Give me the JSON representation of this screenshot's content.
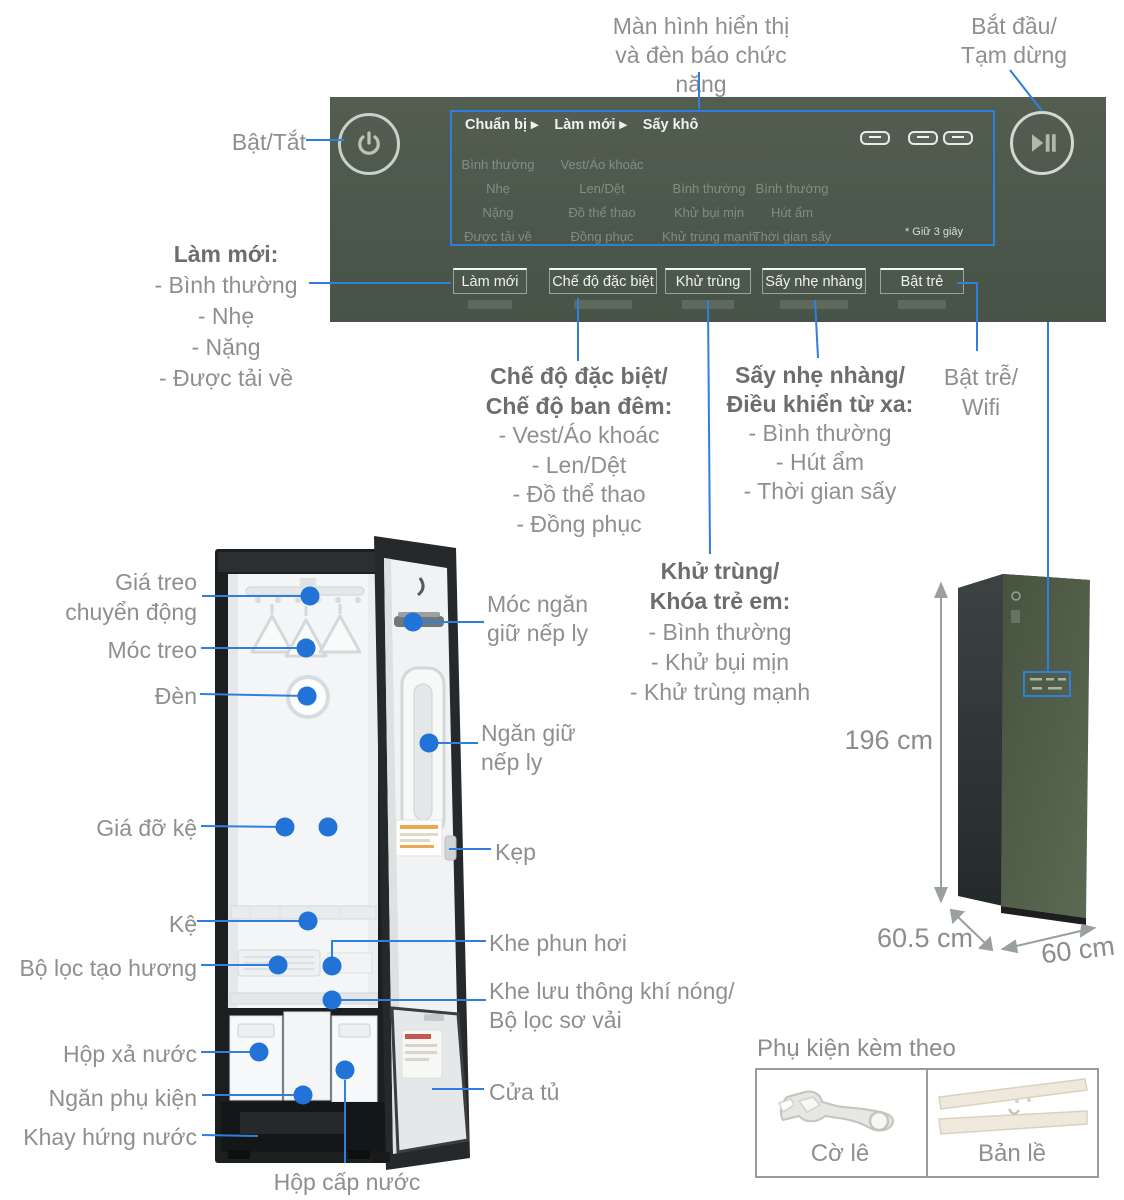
{
  "colors": {
    "accent_blue": "#2f80de",
    "panel_green": "#4e5a4d",
    "appliance_green": "#4a5749",
    "label_gray": "#8f8f8f"
  },
  "callouts": {
    "display": [
      "Màn hình hiển thị",
      "và đèn báo chức năng"
    ],
    "start_pause": [
      "Bắt đầu/",
      "Tạm dừng"
    ],
    "power": "Bật/Tắt",
    "refresh": {
      "title": "Làm mới:",
      "items": [
        "- Bình thường",
        "- Nhẹ",
        "- Nặng",
        "- Được tải về"
      ]
    },
    "special": {
      "title": [
        "Chế độ đặc biệt/",
        "Chế độ ban đêm:"
      ],
      "items": [
        "- Vest/Áo khoác",
        "- Len/Dệt",
        "- Đồ thể thao",
        "- Đồng phục"
      ]
    },
    "gentle": {
      "title": [
        "Sấy nhẹ nhàng/",
        "Điều khiển từ xa:"
      ],
      "items": [
        "- Bình thường",
        "- Hút ẩm",
        "- Thời gian sấy"
      ]
    },
    "delay": [
      "Bật trễ/",
      "Wifi"
    ],
    "sanitize": {
      "title": [
        "Khử trùng/",
        "Khóa trẻ em:"
      ],
      "items": [
        "- Bình thường",
        "- Khử bụi mịn",
        "- Khử trùng mạnh"
      ]
    }
  },
  "panel": {
    "menu": [
      "Chuẩn bị ▸",
      "Làm mới ▸",
      "Sấy khô"
    ],
    "modes": {
      "col1": [
        "Bình thường",
        "Nhẹ",
        "Nặng",
        "Được tải về"
      ],
      "col2": [
        "Vest/Áo khoác",
        "Len/Dệt",
        "Đồ thể thao",
        "Đồng phục"
      ],
      "col3": [
        "Bình thường",
        "Khử bụi mịn",
        "Khử trùng mạnh"
      ],
      "col4": [
        "Bình thường",
        "Hút ẩm",
        "Thời gian sấy"
      ]
    },
    "note": "* Giữ 3 giây",
    "buttons": [
      "Làm mới",
      "Chế độ đặc biệt",
      "Khử trùng",
      "Sấy nhẹ nhàng",
      "Bật trẻ"
    ]
  },
  "interior": {
    "moving_rack": [
      "Giá treo",
      "chuyển động"
    ],
    "hanger": "Móc treo",
    "light": "Đèn",
    "shelf_support": "Giá đỡ kệ",
    "shelf": "Kệ",
    "scent_filter": "Bộ lọc tạo hương",
    "drain_tank": "Hộp xả nước",
    "accessory_tray": "Ngăn phụ kiện",
    "drip_tray": "Khay hứng nước",
    "water_tank": "Hộp cấp nước",
    "crease_hook": [
      "Móc ngăn",
      "giữ nếp ly"
    ],
    "crease_keeper": [
      "Ngăn giữ",
      "nếp ly"
    ],
    "clip": "Kẹp",
    "steam_slot": "Khe phun hơi",
    "vent": [
      "Khe lưu thông khí nóng/",
      "Bộ lọc sơ vải"
    ],
    "door": "Cửa tủ"
  },
  "dimensions": {
    "height": "196 cm",
    "depth": "60.5 cm",
    "width": "60 cm"
  },
  "accessories": {
    "title": "Phụ kiện kèm theo",
    "wrench": "Cờ lê",
    "hinge": "Bản lề"
  }
}
